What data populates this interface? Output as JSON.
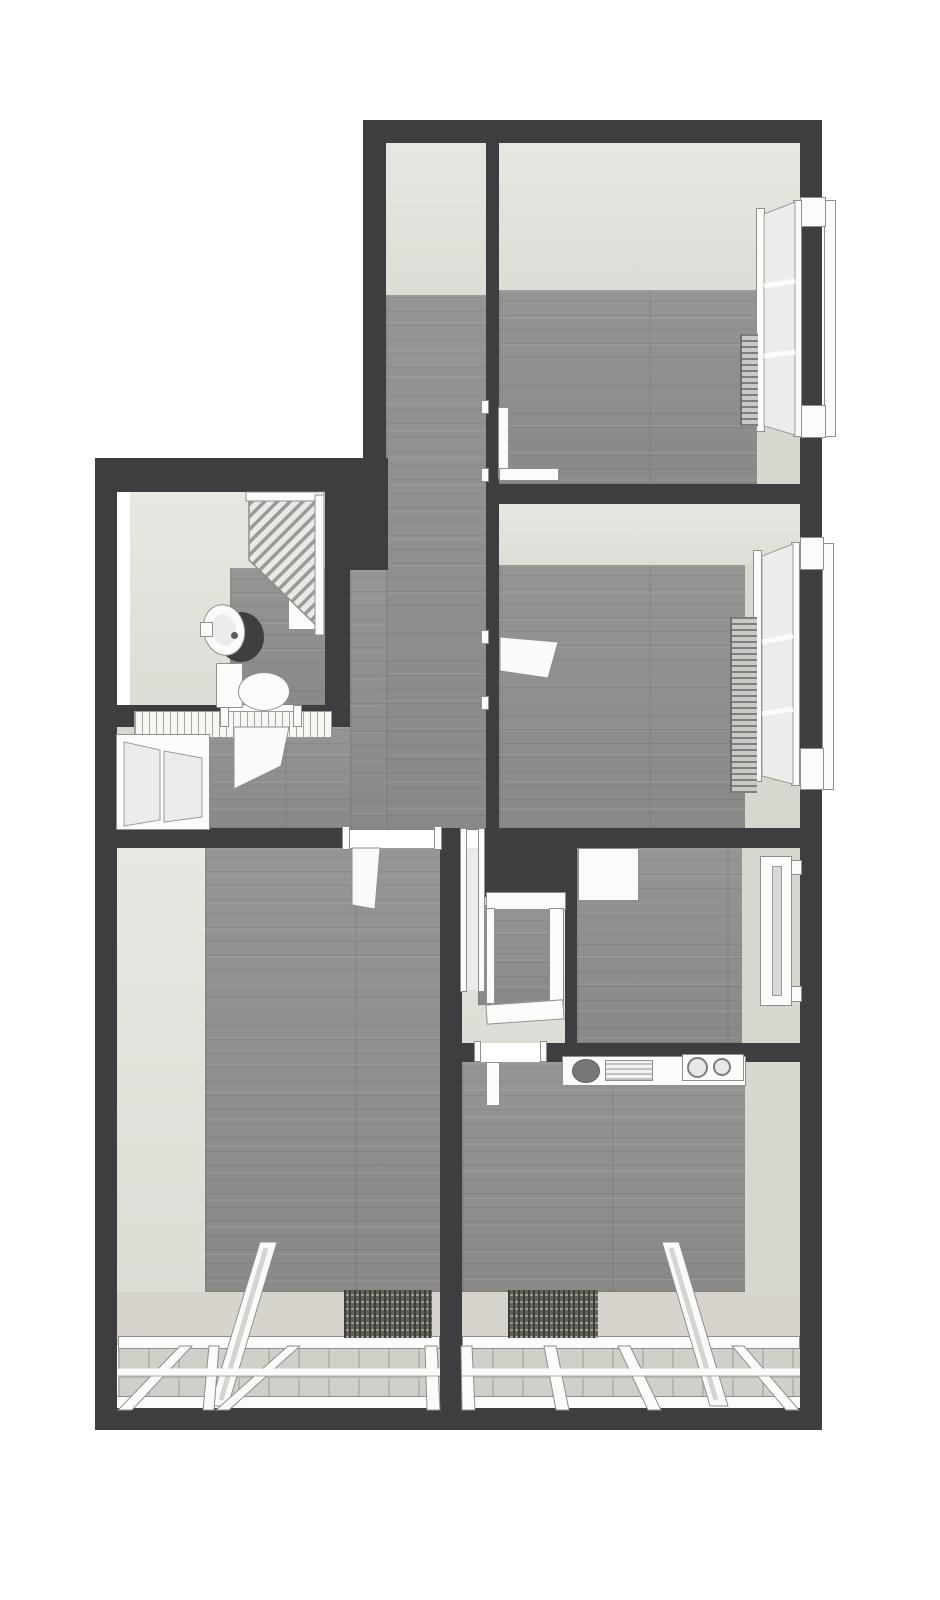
{
  "meta": {
    "kind": "3d-floor-plan-top-down-render",
    "description": "Monochrome 3D bird's-eye floor plan of an apartment with grey wood floors and dark charcoal walls",
    "visible_text": []
  },
  "palette": {
    "canvas": "#ffffff",
    "wall": "#3e3e40",
    "floor": "#8f8e8c",
    "face": "#dddcd5",
    "faceLight": "#e8e7e1",
    "faceDark": "#d7d6cf",
    "balcony": "#d6d4cc",
    "glass": "#ececea",
    "frame": "#fbfbfa",
    "frameStroke": "#8f8f8d",
    "tile": "#d0cfca",
    "tileLine": "#b6b5b0",
    "radDark": "#7e7e7c",
    "radLight": "#c9c8c5"
  },
  "rooms": [
    {
      "id": "bedroom-top",
      "features": [
        "bay-window-right",
        "radiator",
        "door-to-corridor"
      ]
    },
    {
      "id": "bedroom-middle",
      "features": [
        "bay-window-right",
        "radiator",
        "door-to-corridor"
      ]
    },
    {
      "id": "corridor",
      "features": [
        "runs-north-south"
      ]
    },
    {
      "id": "bathroom",
      "features": [
        "shower",
        "washbasin",
        "toilet",
        "door-to-hallway"
      ]
    },
    {
      "id": "hallway",
      "features": [
        "window-left",
        "radiator-rail"
      ]
    },
    {
      "id": "vestibule-closet",
      "features": [
        "shaft",
        "open-shelf-unit",
        "door-to-hallway",
        "door-to-kitchen"
      ]
    },
    {
      "id": "small-room",
      "features": [
        "window-right",
        "door-leaf-open"
      ]
    },
    {
      "id": "living-room",
      "features": [
        "balcony-glazing-south",
        "doormat",
        "glass-railing",
        "door-to-hallway"
      ]
    },
    {
      "id": "kitchen",
      "features": [
        "counter-with-sink-and-cooktop",
        "balcony-glazing-south",
        "doormat",
        "glass-railing"
      ]
    }
  ],
  "fixtures": {
    "radiator_count": 3,
    "cooktop_burners": 2,
    "doormats": 2,
    "glass_railings": 2,
    "windows": 5,
    "open_doors": 6
  }
}
